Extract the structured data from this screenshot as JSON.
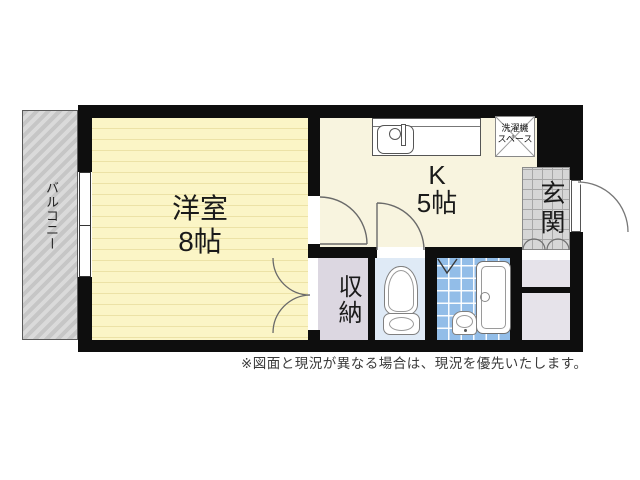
{
  "plan_type": "apartment-floorplan",
  "rooms": {
    "balcony": {
      "name": "バルコニー"
    },
    "western": {
      "name": "洋室",
      "size": "8帖"
    },
    "kitchen": {
      "name": "K",
      "size": "5帖"
    },
    "storage": {
      "name": "収納"
    },
    "entrance": {
      "name": "玄関"
    },
    "washer_space": {
      "name": "洗濯機\nスペース"
    }
  },
  "fixtures": [
    "kitchen-sink",
    "washing-machine-space",
    "toilet",
    "bathtub",
    "bath-sink",
    "front-door",
    "balcony-window",
    "room-door",
    "toilet-door",
    "closet-double-doors",
    "bath-folding-door"
  ],
  "colors": {
    "wall": "#0e0e0e",
    "western_room_fill": "#fbf5c6",
    "western_room_stripe": "#ece2a6",
    "kitchen_fill": "#f8f4df",
    "storage_fill": "#dcd7e1",
    "toilet_fill": "#dfeaf6",
    "bath_tile": "#92bde8",
    "entrance_tile": "#d6d6d6",
    "shoebox_fill": "#e6e3ea",
    "balcony_fill": "#c6c6c6"
  },
  "footer": {
    "disclaimer": "※図面と現況が異なる場合は、現況を優先いたします。"
  }
}
